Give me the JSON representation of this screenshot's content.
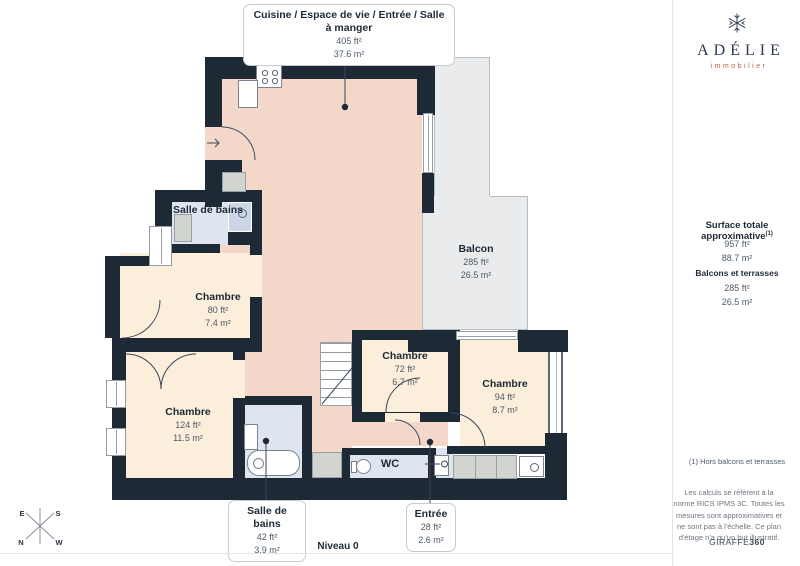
{
  "colors": {
    "wall": "#1e2936",
    "kitchen": "#f3d8ca",
    "bedroom": "#fbeeda",
    "bath": "#dfe5ef",
    "shower": "#ccd6e7",
    "balcony": "#e9ebed",
    "balcony-border": "#b7bcc2",
    "fixture-gray": "#d2d4cf",
    "line": "#39465a",
    "ink": "#1d2937",
    "muted": "#4d5968",
    "box-border": "#c7cbd1",
    "brand-orange": "#c2633c",
    "divider": "#e4e5e7",
    "faint": "#6e7681"
  },
  "plan": {
    "level_label": "Niveau 0",
    "callouts": [
      {
        "title": "Cuisine / Espace de vie / Entrée / Salle à manger",
        "ft": "405 ft²",
        "m": "37.6 m²"
      },
      {
        "title": "Salle de bains",
        "ft": "42 ft²",
        "m": "3.9 m²"
      },
      {
        "title": "Entrée",
        "ft": "28 ft²",
        "m": "2.6 m²"
      }
    ],
    "rooms": [
      {
        "name": "Salle de bains"
      },
      {
        "name": "Chambre",
        "ft": "80 ft²",
        "m": "7.4 m²"
      },
      {
        "name": "Balcon",
        "ft": "285 ft²",
        "m": "26.5 m²"
      },
      {
        "name": "Chambre",
        "ft": "72 ft²",
        "m": "6.7 m²"
      },
      {
        "name": "Chambre",
        "ft": "94 ft²",
        "m": "8.7 m²"
      },
      {
        "name": "Chambre",
        "ft": "124 ft²",
        "m": "11.5 m²"
      },
      {
        "name": "WC"
      }
    ],
    "compass": {
      "top_left": "E",
      "top_right": "S",
      "bottom_left": "N",
      "bottom_right": "W"
    }
  },
  "sidebar": {
    "brand_name": "ADÉLIE",
    "brand_subtitle": "immobilier",
    "surface_title": "Surface totale approximative",
    "surface_sup": "(1)",
    "surface_ft": "957 ft²",
    "surface_m": "88.7 m²",
    "terrace_title": "Balcons et terrasses",
    "terrace_ft": "285 ft²",
    "terrace_m": "26.5 m²",
    "footnote": "(1) Hors balcons et terrasses",
    "disclaimer": "Les calculs se réfèrent à la norme RICS IPMS 3C. Toutes les mesures sont approximatives et ne sont pas à l'échelle. Ce plan d'étage n'a qu'un but illustratif.",
    "watermark_regular": "GIRAFFE",
    "watermark_bold": "360"
  }
}
